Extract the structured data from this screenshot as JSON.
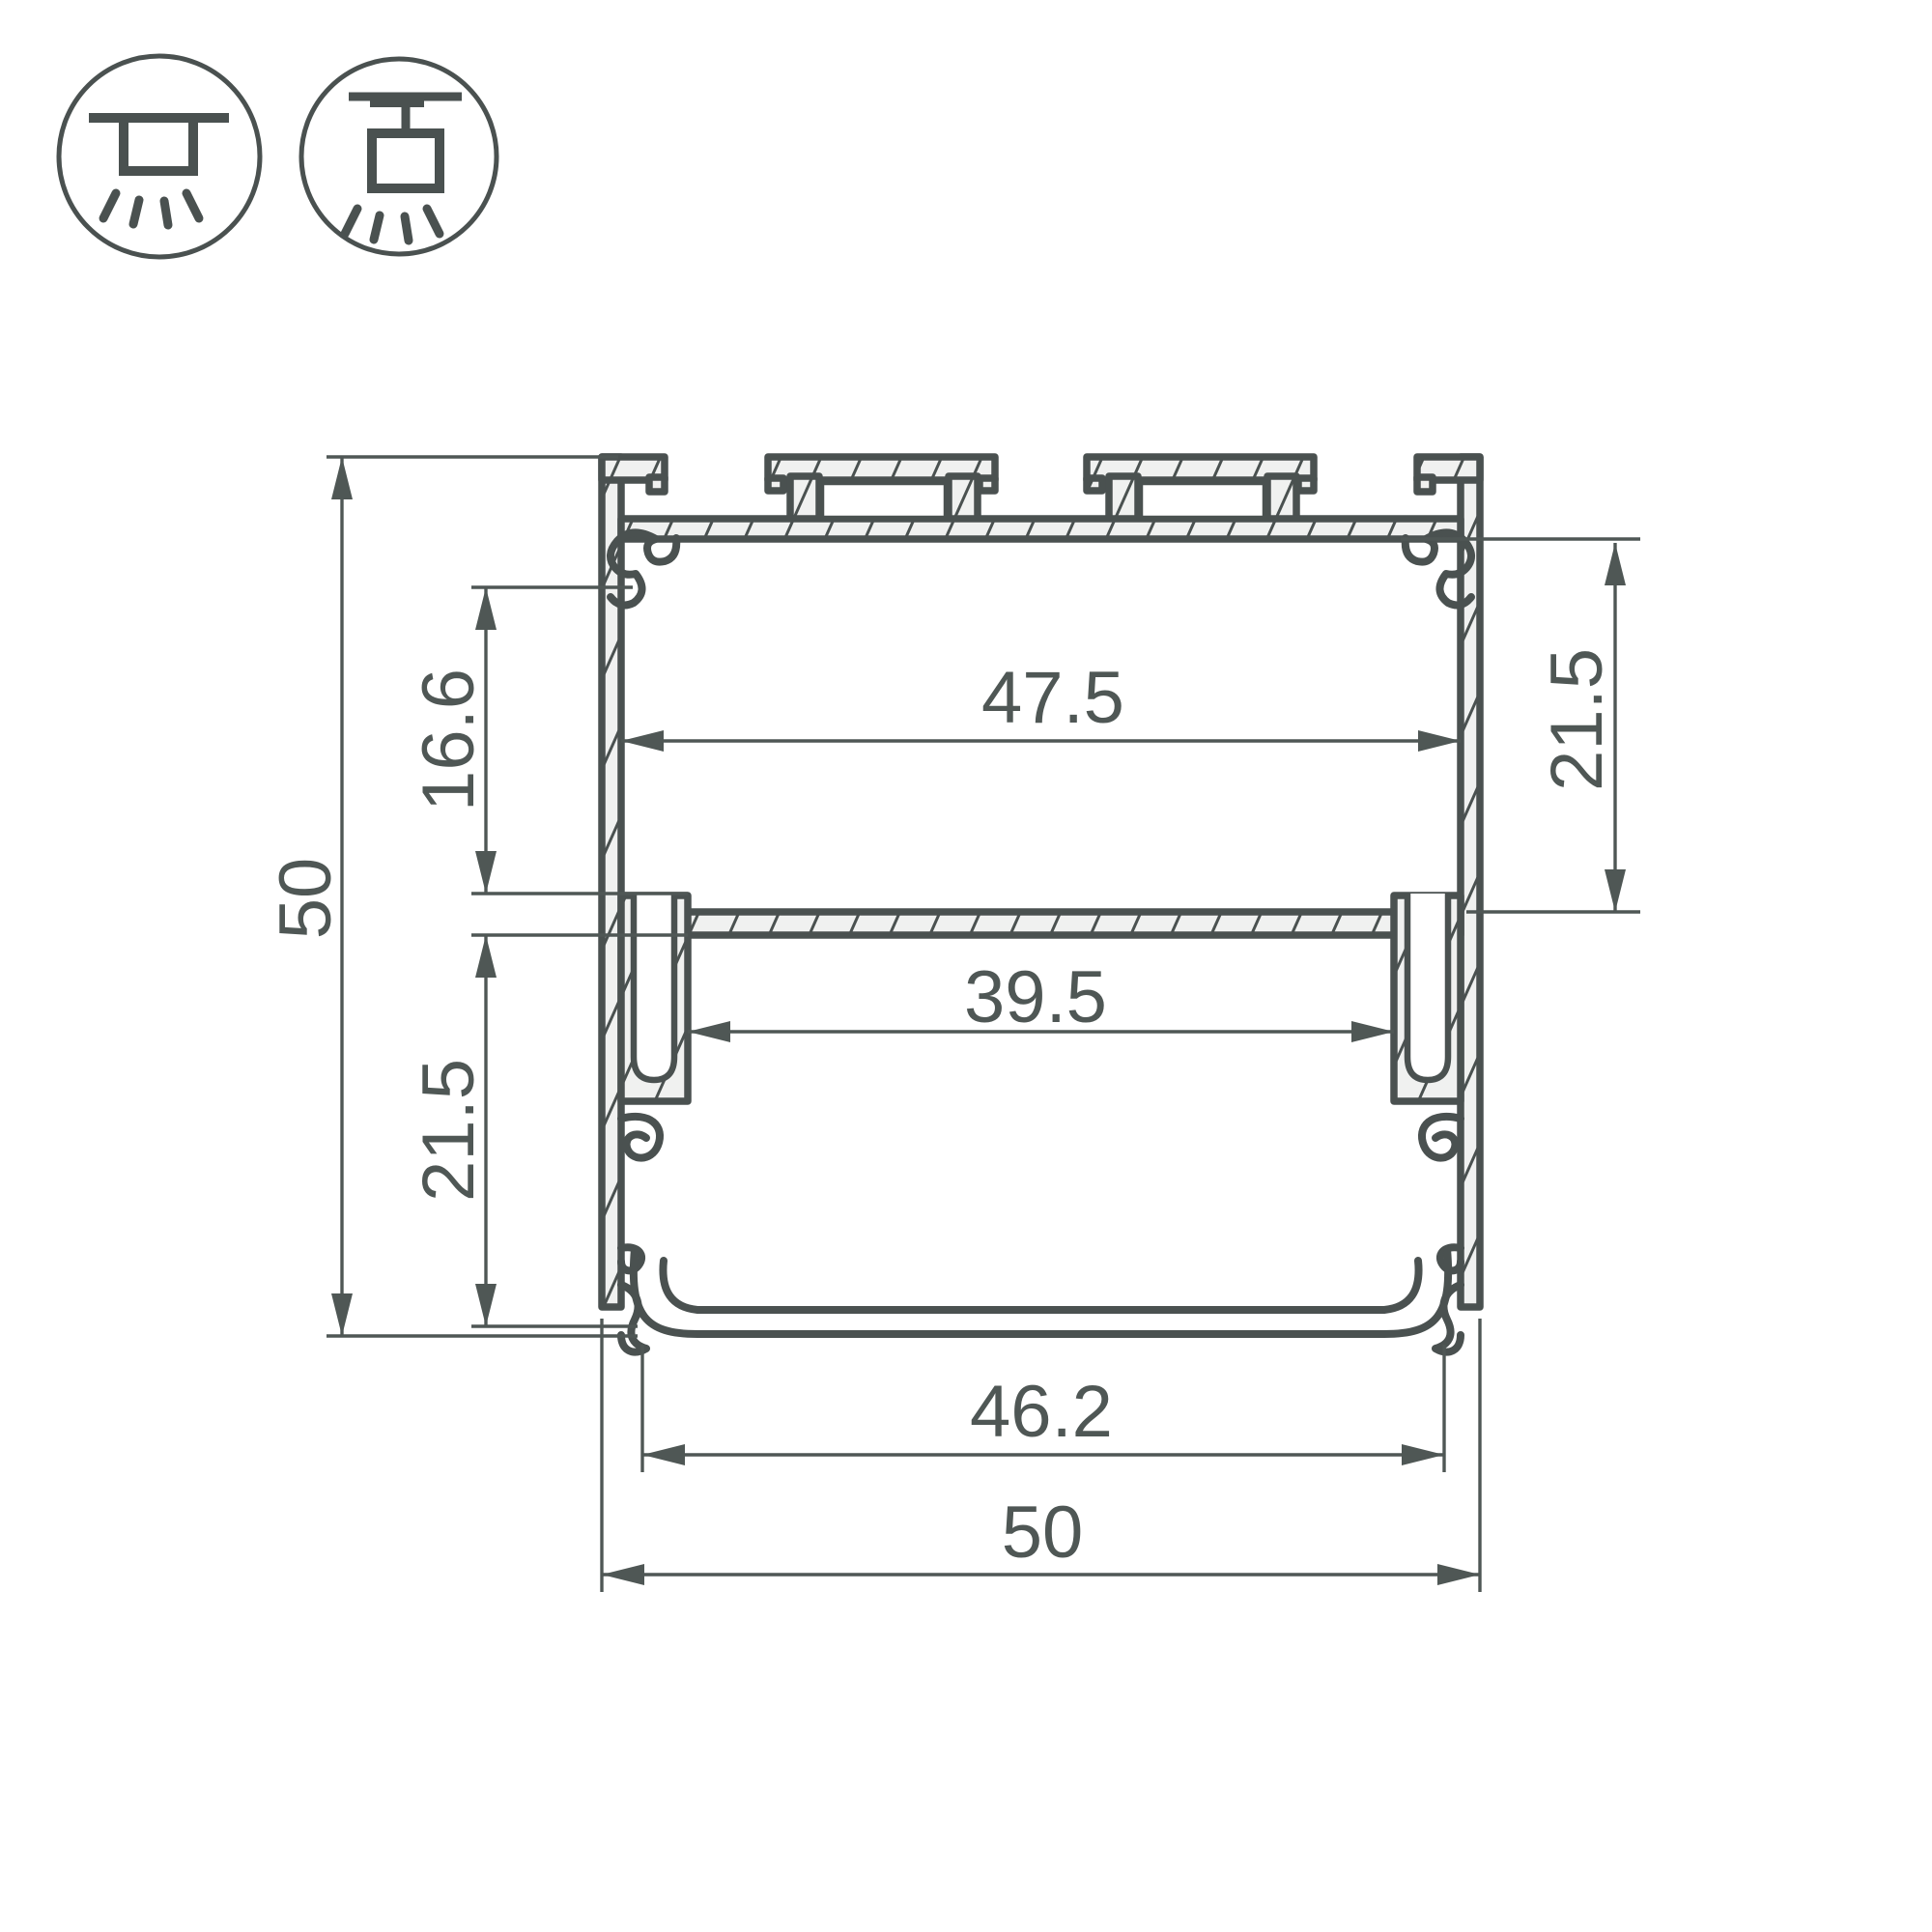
{
  "drawing": {
    "title": "led-profile-cross-section",
    "dimensions": {
      "overall_height": "50",
      "upper_inner_height": "16.6",
      "lower_left_inner_height": "21.5",
      "upper_inner_width": "47.5",
      "right_inner_height": "21.5",
      "lower_inner_width": "39.5",
      "diffuser_width": "46.2",
      "overall_width": "50"
    },
    "mount_icons": [
      {
        "name": "surface-mount-icon"
      },
      {
        "name": "pendant-mount-icon"
      }
    ],
    "colors": {
      "line": "#4a5150",
      "dim": "#4f5755",
      "fill": "#f0f1f0",
      "background": "#ffffff"
    }
  }
}
